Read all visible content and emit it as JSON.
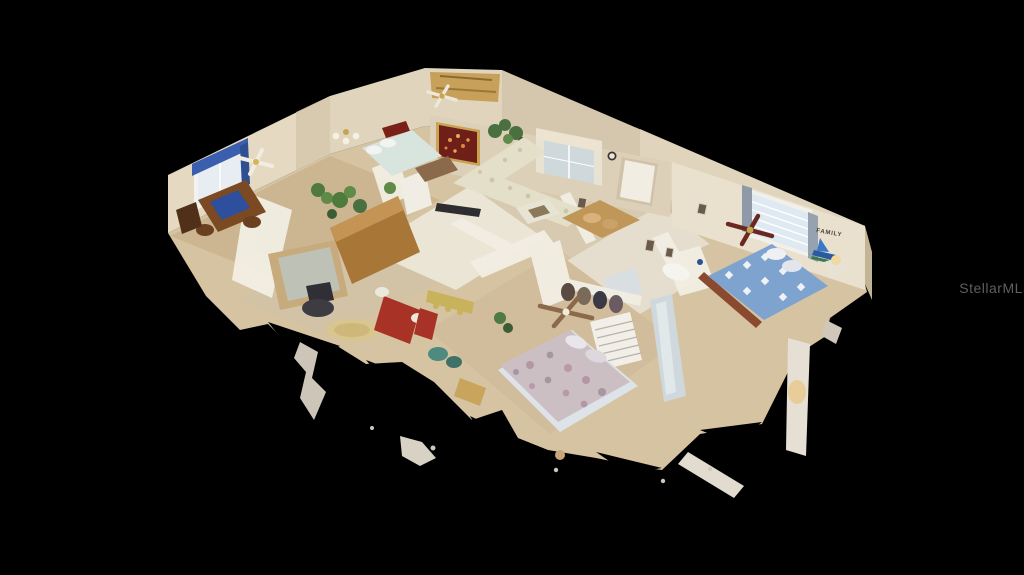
{
  "scene": {
    "type": "3D dollhouse cutaway view of a single-story furnished home, virtual-tour screenshot on black background",
    "background_color": "#000000",
    "watermark": {
      "text": "StellarMLS",
      "color": "#67676c",
      "position": "center-right"
    },
    "family_sign": {
      "text": "FAMILY"
    },
    "rooms_visible": [
      "den / game room with blue-topped table",
      "home office with glass-top desk",
      "kitchen with wood cabinets",
      "breakfast nook with red table",
      "living room with floral sectional sofa",
      "entry with white front door and wall clock",
      "hallway with picture frames",
      "bathroom",
      "guest bedroom with blue-and-white quilt bed",
      "master bedroom with floral bedspread and white dresser"
    ],
    "notable_items": [
      "blue valance den window",
      "lighted-branch wall niche",
      "scalloped cornice living-room window",
      "FAMILY wall sign with sailboat art",
      "multiple ceiling fans",
      "ragged scan cutoff fragments at bottom"
    ]
  },
  "palette": {
    "wall_cream": "#e5d9c2",
    "wall_shadow": "#d4c7ae",
    "floor_tan": "#d5c3a2",
    "kitchen_tile": "#eae5d5",
    "cabinet_wood": "#a87636",
    "quilt_blue": "#7fa3cf",
    "bedspread_mauve": "#ccbfc4",
    "sofa_cream": "#e3dfc9",
    "niche_red": "#6e2018",
    "valance_blue": "#3b5fae",
    "nook_red": "#a83226",
    "ceiling_gold": "#c49a4e"
  }
}
